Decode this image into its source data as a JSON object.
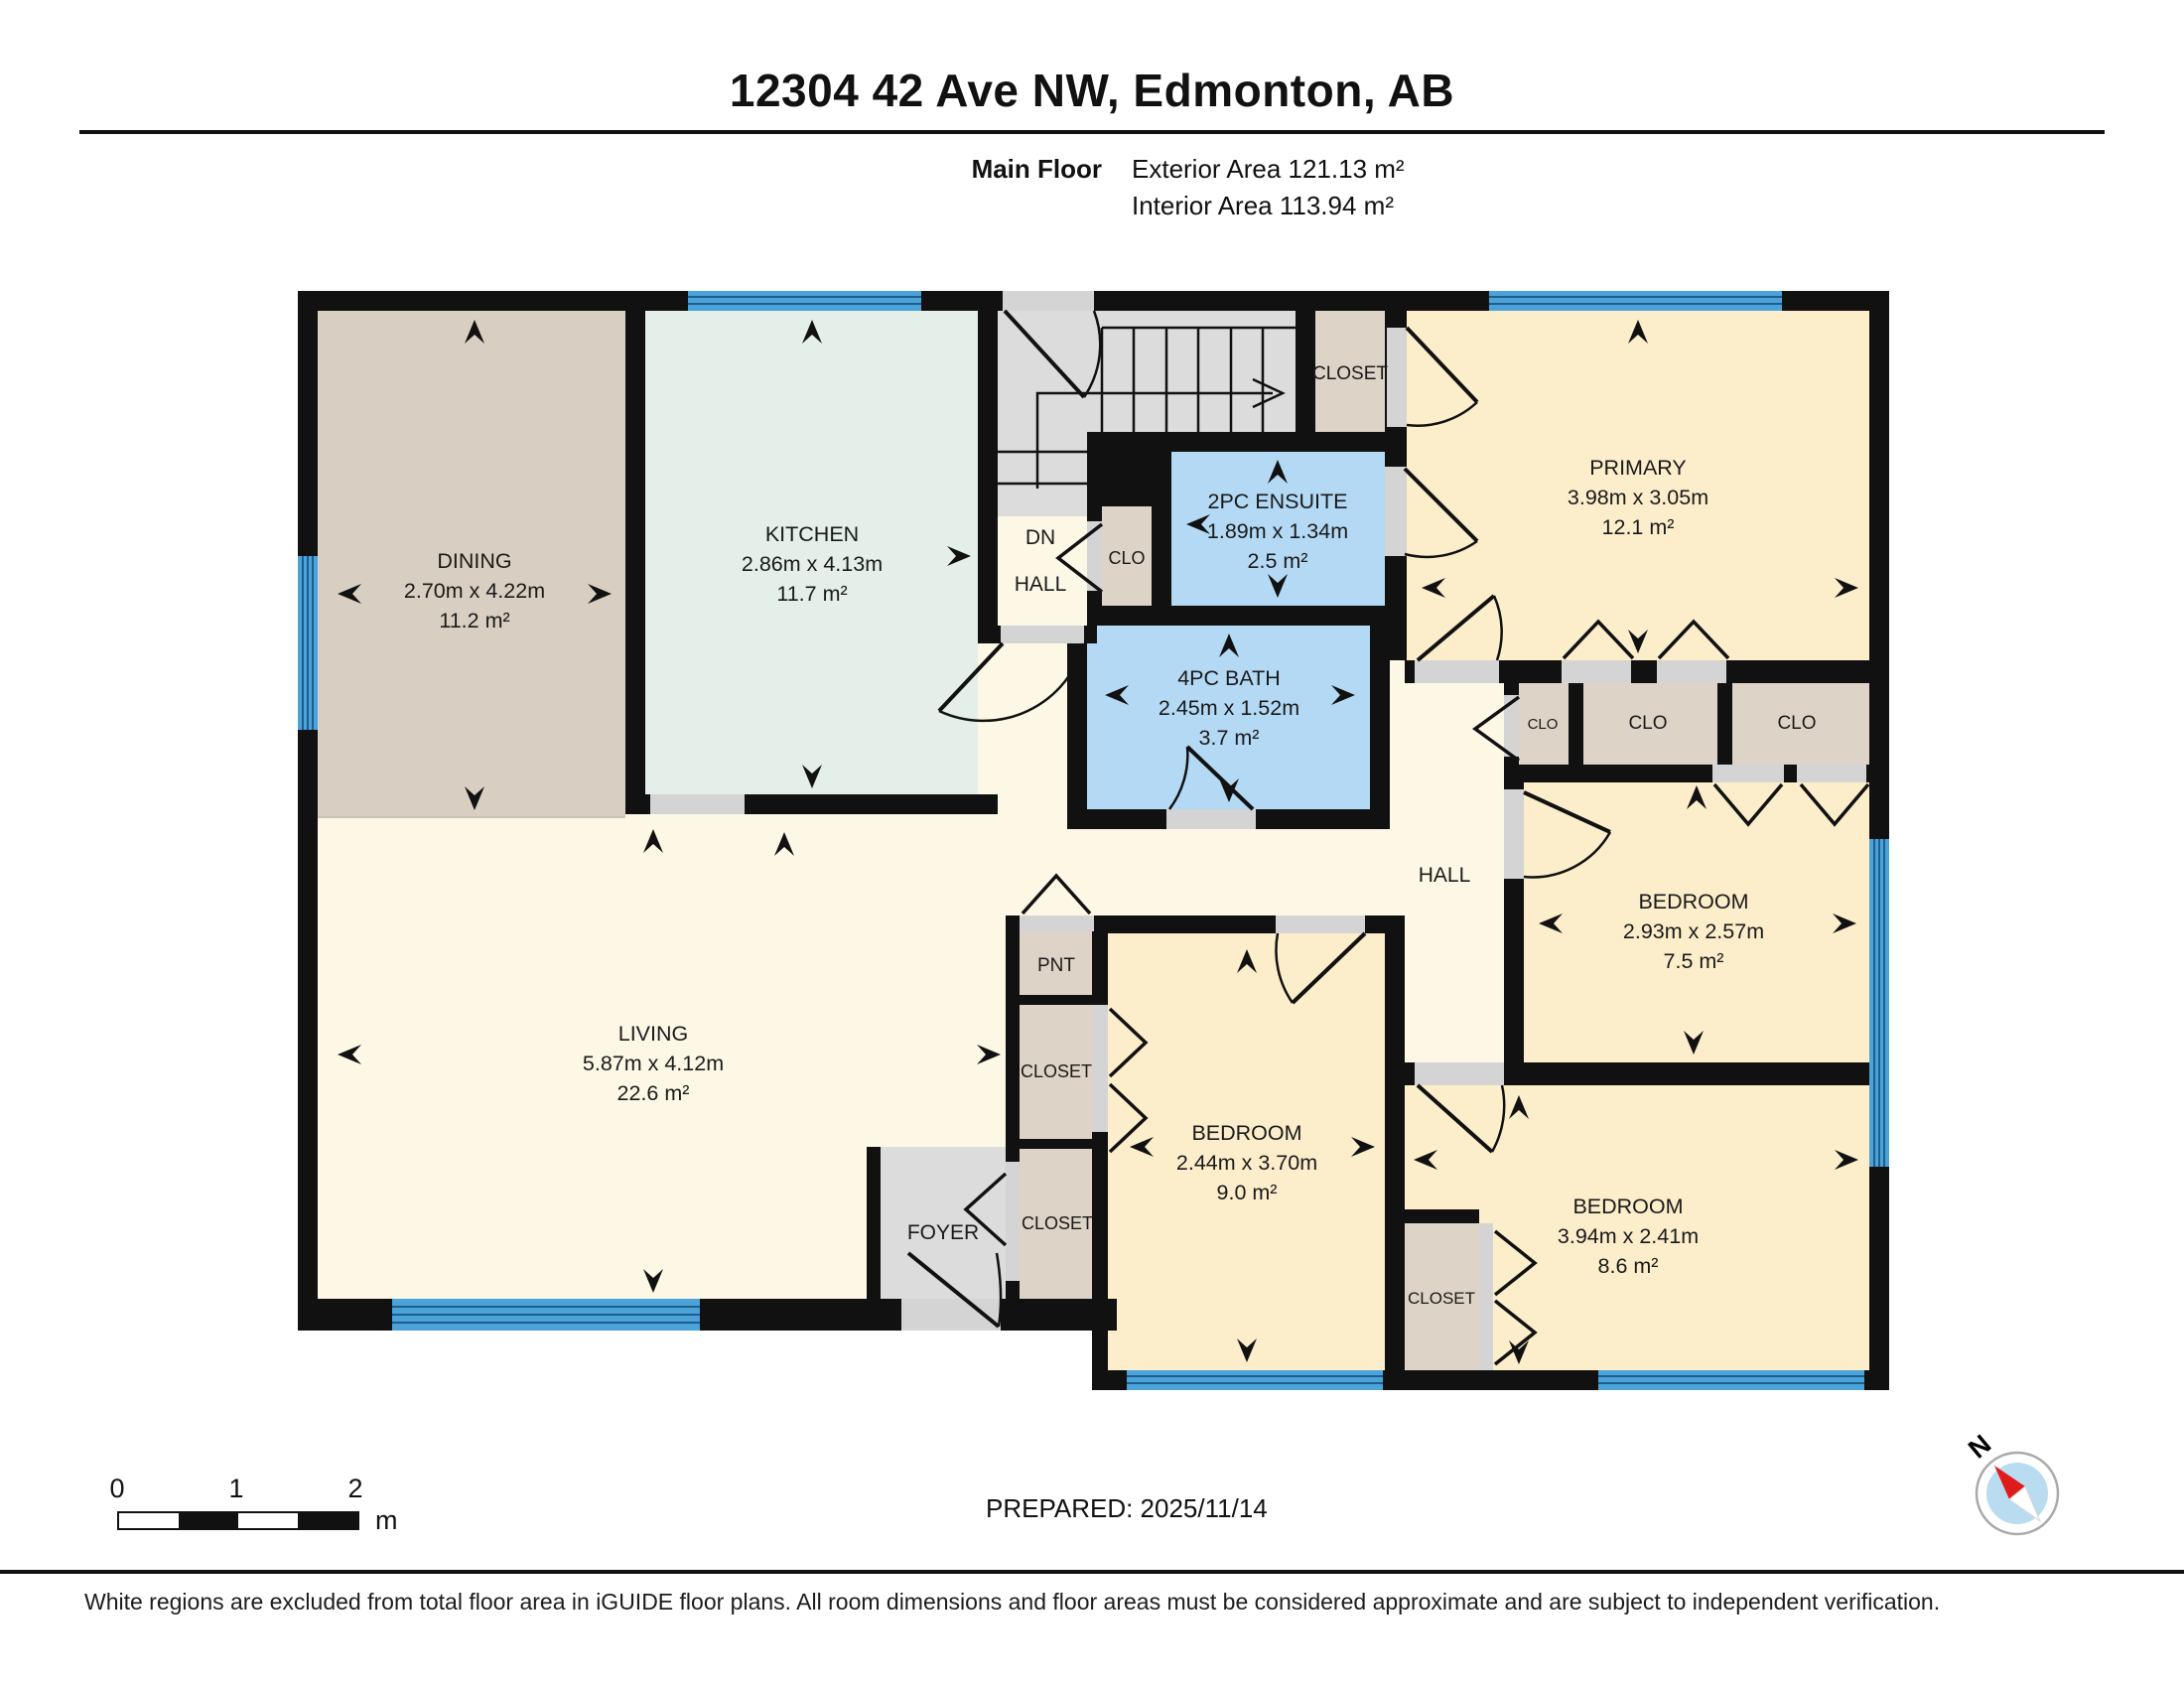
{
  "header": {
    "title": "12304 42 Ave NW, Edmonton, AB",
    "floor_label": "Main Floor",
    "exterior_area": "Exterior Area 121.13 m²",
    "interior_area": "Interior Area 113.94 m²"
  },
  "plan": {
    "rooms": [
      {
        "id": "dining",
        "name": "DINING",
        "dims": "2.70m x 4.22m",
        "area": "11.2 m²"
      },
      {
        "id": "kitchen",
        "name": "KITCHEN",
        "dims": "2.86m x 4.13m",
        "area": "11.7 m²"
      },
      {
        "id": "living",
        "name": "LIVING",
        "dims": "5.87m x 4.12m",
        "area": "22.6 m²"
      },
      {
        "id": "primary",
        "name": "PRIMARY",
        "dims": "3.98m x 3.05m",
        "area": "12.1 m²"
      },
      {
        "id": "ensuite",
        "name": "2PC ENSUITE",
        "dims": "1.89m x 1.34m",
        "area": "2.5 m²"
      },
      {
        "id": "bath",
        "name": "4PC BATH",
        "dims": "2.45m x 1.52m",
        "area": "3.7 m²"
      },
      {
        "id": "bedroom-ne",
        "name": "BEDROOM",
        "dims": "2.93m x 2.57m",
        "area": "7.5 m²"
      },
      {
        "id": "bedroom-mid",
        "name": "BEDROOM",
        "dims": "2.44m x 3.70m",
        "area": "9.0 m²"
      },
      {
        "id": "bedroom-se",
        "name": "BEDROOM",
        "dims": "3.94m x 2.41m",
        "area": "8.6 m²"
      }
    ],
    "labels": [
      {
        "id": "dn",
        "text": "DN"
      },
      {
        "id": "hall-upper",
        "text": "HALL"
      },
      {
        "id": "clo-hall",
        "text": "CLO"
      },
      {
        "id": "closet-stairs",
        "text": "CLOSET"
      },
      {
        "id": "hall-lower",
        "text": "HALL"
      },
      {
        "id": "clo-a",
        "text": "CLO"
      },
      {
        "id": "clo-b",
        "text": "CLO"
      },
      {
        "id": "clo-c",
        "text": "CLO"
      },
      {
        "id": "pnt",
        "text": "PNT"
      },
      {
        "id": "closet-1",
        "text": "CLOSET"
      },
      {
        "id": "closet-2",
        "text": "CLOSET"
      },
      {
        "id": "foyer",
        "text": "FOYER"
      },
      {
        "id": "closet-b",
        "text": "CLOSET"
      }
    ],
    "colors": {
      "wall": "#111111",
      "dining": "#d8cec2",
      "kitchen": "#e3efe8",
      "cream": "#fdf8e6",
      "bedroom": "#fceecb",
      "bathroom": "#b3d9f5",
      "closet": "#ddd3c7",
      "stairs": "#dcdcdc",
      "window": "#4ba3d9",
      "door_opening": "#d4d4d4"
    }
  },
  "scale_bar": {
    "ticks": [
      "0",
      "1",
      "2"
    ],
    "unit": "m"
  },
  "prepared": "PREPARED: 2025/11/14",
  "compass": {
    "label": "N"
  },
  "footer": "White regions are excluded from total floor area in iGUIDE floor plans. All room dimensions and floor areas must be considered approximate and are subject to independent verification."
}
